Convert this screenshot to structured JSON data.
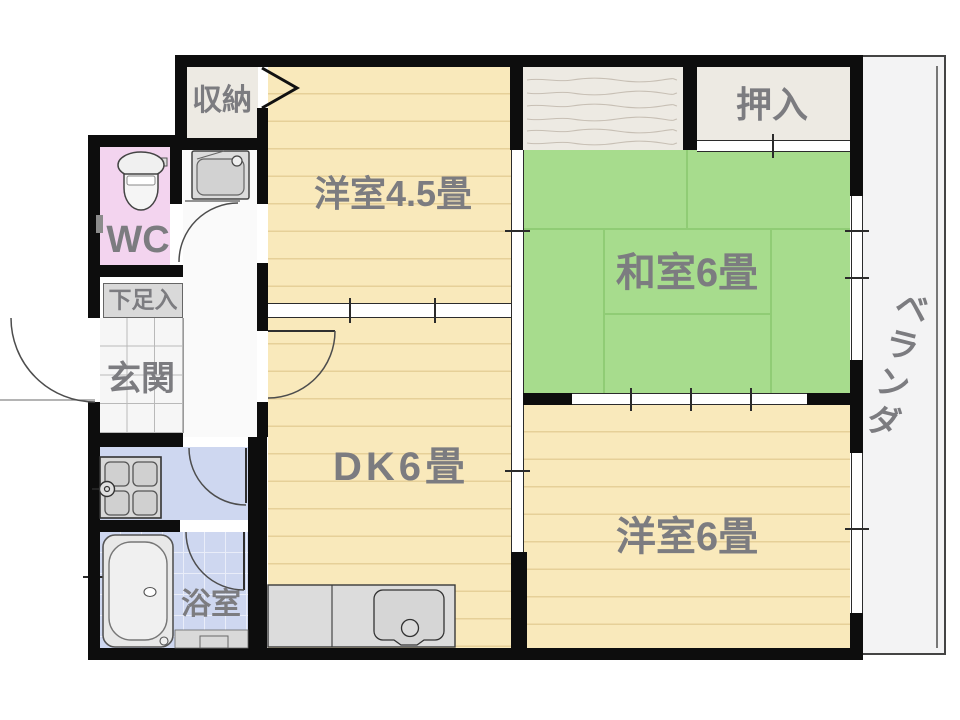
{
  "title": "apartment floor plan",
  "colors": {
    "wall": "#0d0d0d",
    "floor_cream": "#f9e9bb",
    "floor_line": "#e6d098",
    "tatami_green": "#a7dc8d",
    "tatami_line": "#90cc75",
    "wc_pink": "#f3d4ef",
    "water_blue": "#ced7f0",
    "closet_beige": "#edeae3",
    "hallway_white": "#fafafa",
    "veranda_gray": "#f3f3f4",
    "fixture_gray": "#d9d9d9",
    "label_gray": "#7c7c80",
    "genkan_tile": "#f6f6f6"
  },
  "rooms": {
    "storage": {
      "label": "収納"
    },
    "western_room_45": {
      "label": "洋室4.5畳"
    },
    "closet": {
      "label": "押入"
    },
    "japanese_room": {
      "label": "和室6畳"
    },
    "balcony": {
      "label": "ベランダ"
    },
    "wc": {
      "label": "WC"
    },
    "shoe_cabinet": {
      "label": "下足入"
    },
    "entrance": {
      "label": "玄関"
    },
    "dining_kitchen": {
      "label": "DK6畳"
    },
    "western_room_6": {
      "label": "洋室6畳"
    },
    "bathroom": {
      "label": "浴室"
    }
  }
}
